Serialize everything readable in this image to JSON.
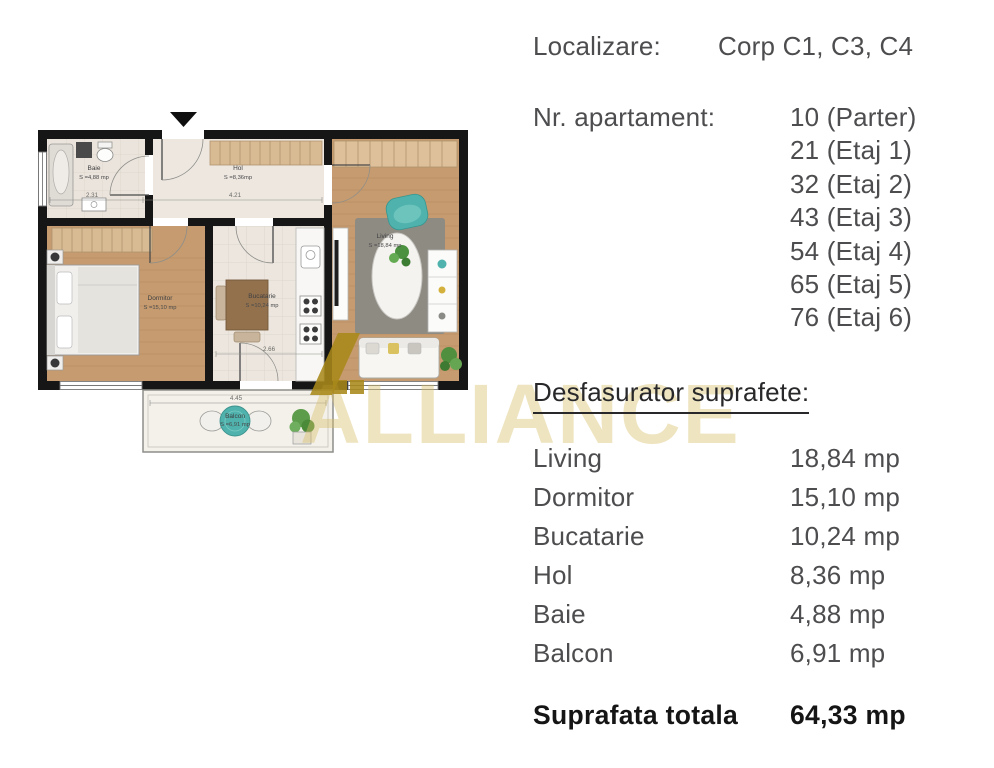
{
  "info": {
    "localizare": {
      "label": "Localizare:",
      "value": "Corp C1, C3, C4"
    },
    "apartament": {
      "label": "Nr. apartament:",
      "values": [
        "10 (Parter)",
        "21 (Etaj 1)",
        "32 (Etaj 2)",
        "43 (Etaj 3)",
        "54 (Etaj 4)",
        "65 (Etaj 5)",
        "76 (Etaj 6)"
      ]
    },
    "surfaces": {
      "heading": "Desfasurator suprafete:",
      "rows": [
        {
          "room": "Living",
          "area": "18,84 mp"
        },
        {
          "room": "Dormitor",
          "area": "15,10 mp"
        },
        {
          "room": "Bucatarie",
          "area": "10,24 mp"
        },
        {
          "room": "Hol",
          "area": "8,36 mp"
        },
        {
          "room": "Baie",
          "area": "4,88 mp"
        },
        {
          "room": "Balcon",
          "area": "6,91 mp"
        }
      ],
      "total_label": "Suprafata totala",
      "total_area": "64,33 mp"
    }
  },
  "floorplan": {
    "watermark": "ALLIANCE",
    "rooms": [
      {
        "name": "Baie",
        "area": "S =4,88 mp"
      },
      {
        "name": "Hol",
        "area": "S =8,36mp"
      },
      {
        "name": "Dormitor",
        "area": "S =15,10 mp"
      },
      {
        "name": "Bucatarie",
        "area": "S =10,24 mp"
      },
      {
        "name": "Living",
        "area": "S =18,84 mp"
      },
      {
        "name": "Balcon",
        "area": "S =6,91 mp"
      }
    ],
    "dimensions": {
      "baie_width": "2.31",
      "hol_width": "4.21",
      "bucatarie_width": "2.66",
      "balcon_width": "4.45"
    },
    "colors": {
      "wall": "#161616",
      "wood": "#c59b6f",
      "tile": "#ece6de",
      "rug": "#8e8b83",
      "teal": "#4fb2ac",
      "watermark_gold": "#a8891a",
      "watermark_light": "#d8c06a"
    }
  }
}
